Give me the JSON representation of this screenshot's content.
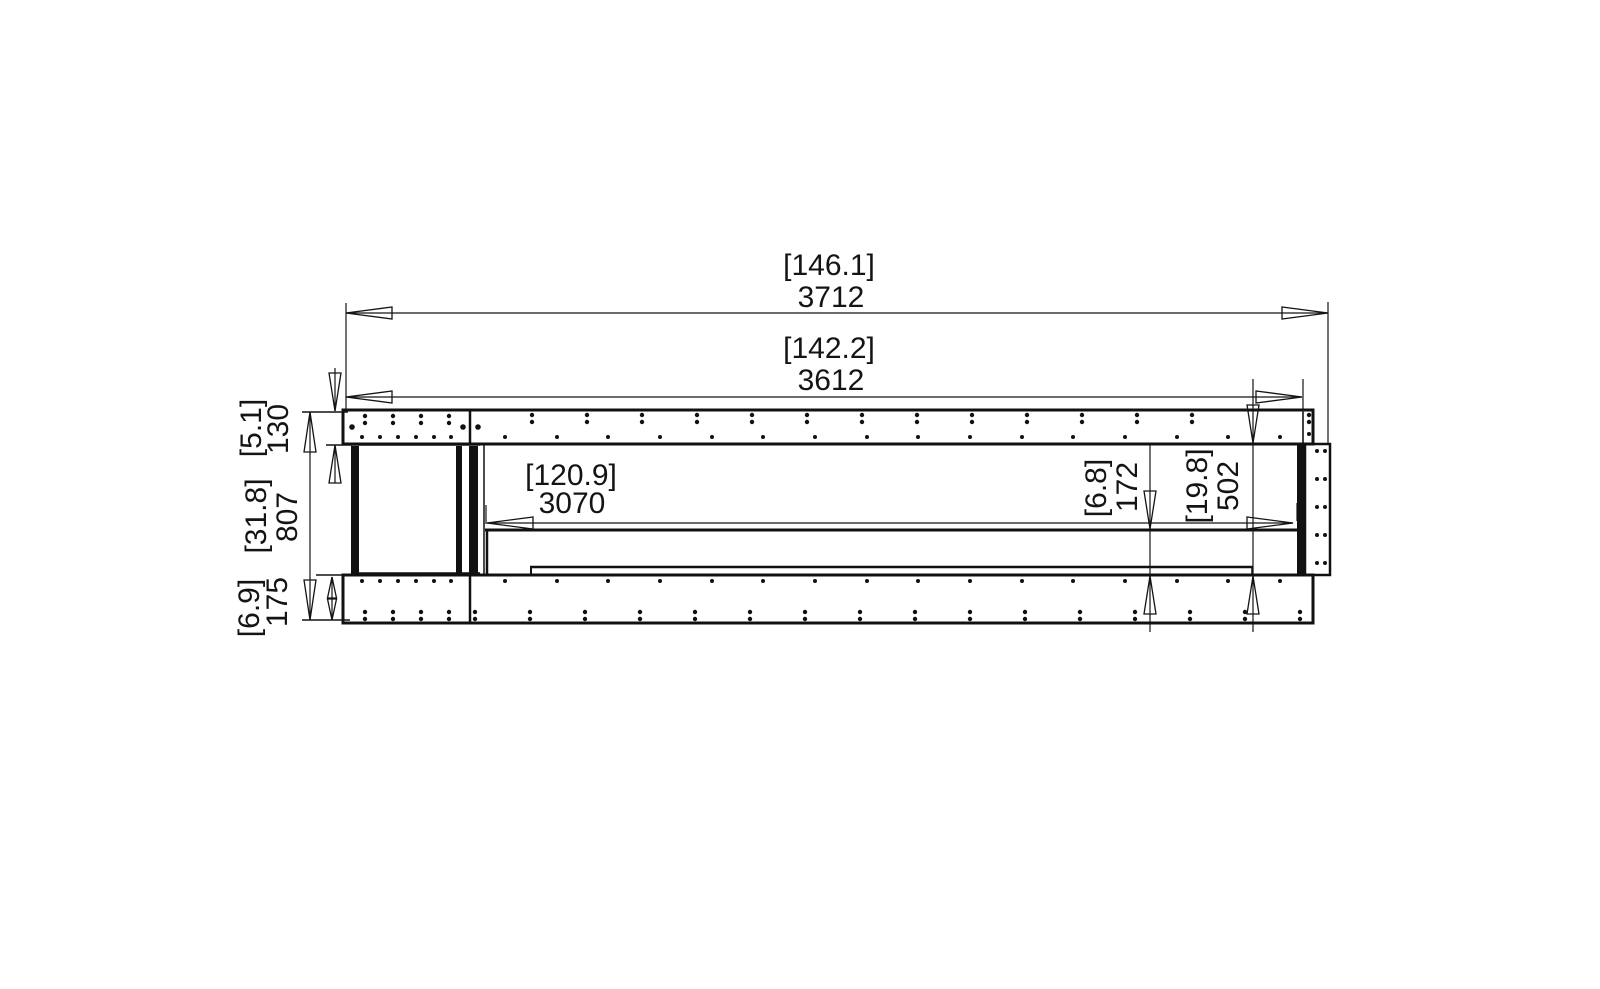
{
  "drawing": {
    "background": "#ffffff",
    "ink": "#141414",
    "labels": {
      "overall_width": {
        "in": "[146.1]",
        "mm": "3712"
      },
      "frame_width": {
        "in": "[142.2]",
        "mm": "3612"
      },
      "burner_width": {
        "in": "[120.9]",
        "mm": "3070"
      },
      "top_frame_height": {
        "in": "[5.1]",
        "mm": "130"
      },
      "overall_height": {
        "in": "[31.8]",
        "mm": "807"
      },
      "base_height": {
        "in": "[6.9]",
        "mm": "175"
      },
      "firebox_depth": {
        "in": "[6.8]",
        "mm": "172"
      },
      "window_height": {
        "in": "[19.8]",
        "mm": "502"
      }
    },
    "fastener_rows": [
      {
        "type": "vpair",
        "xs": [
          365,
          393,
          421,
          449
        ],
        "y1": 416,
        "y2": 423,
        "r": 2.2
      },
      {
        "type": "vpair",
        "xs": [
          532,
          587,
          642,
          697,
          752,
          807,
          862,
          917,
          972,
          1027,
          1082,
          1137,
          1192,
          1309
        ],
        "y1": 415,
        "y2": 422,
        "r": 2.2
      },
      {
        "type": "dot",
        "xs": [
          362,
          380,
          398,
          416,
          434,
          451
        ],
        "y": 437,
        "r": 2
      },
      {
        "type": "dot",
        "xs": [
          505,
          557,
          608,
          660,
          712,
          763,
          815,
          867,
          918,
          970,
          1022,
          1073,
          1125,
          1177,
          1228,
          1280
        ],
        "y": 437,
        "r": 2
      },
      {
        "type": "dot",
        "xs": [
          352,
          463,
          478
        ],
        "y": 427,
        "r": 2.8
      },
      {
        "type": "dot",
        "xs": [
          1309
        ],
        "y": 434,
        "r": 2
      },
      {
        "type": "dot",
        "xs": [
          362,
          380,
          398,
          416,
          434,
          451
        ],
        "y": 581,
        "r": 2
      },
      {
        "type": "dot",
        "xs": [
          505,
          557,
          608,
          660,
          712,
          763,
          815,
          867,
          918,
          970,
          1022,
          1073,
          1125,
          1177,
          1228,
          1280
        ],
        "y": 581,
        "r": 2
      },
      {
        "type": "vpair",
        "xs": [
          365,
          393,
          421,
          449
        ],
        "y1": 612,
        "y2": 619,
        "r": 2.2
      },
      {
        "type": "vpair",
        "xs": [
          475,
          530,
          585,
          640,
          695,
          750,
          805,
          860,
          915,
          970,
          1025,
          1080,
          1135,
          1190,
          1245,
          1300
        ],
        "y1": 612,
        "y2": 619,
        "r": 2.2
      },
      {
        "type": "hpair",
        "ys": [
          451,
          479,
          507,
          535,
          563
        ],
        "x1": 1317,
        "x2": 1325,
        "r": 2
      }
    ]
  }
}
